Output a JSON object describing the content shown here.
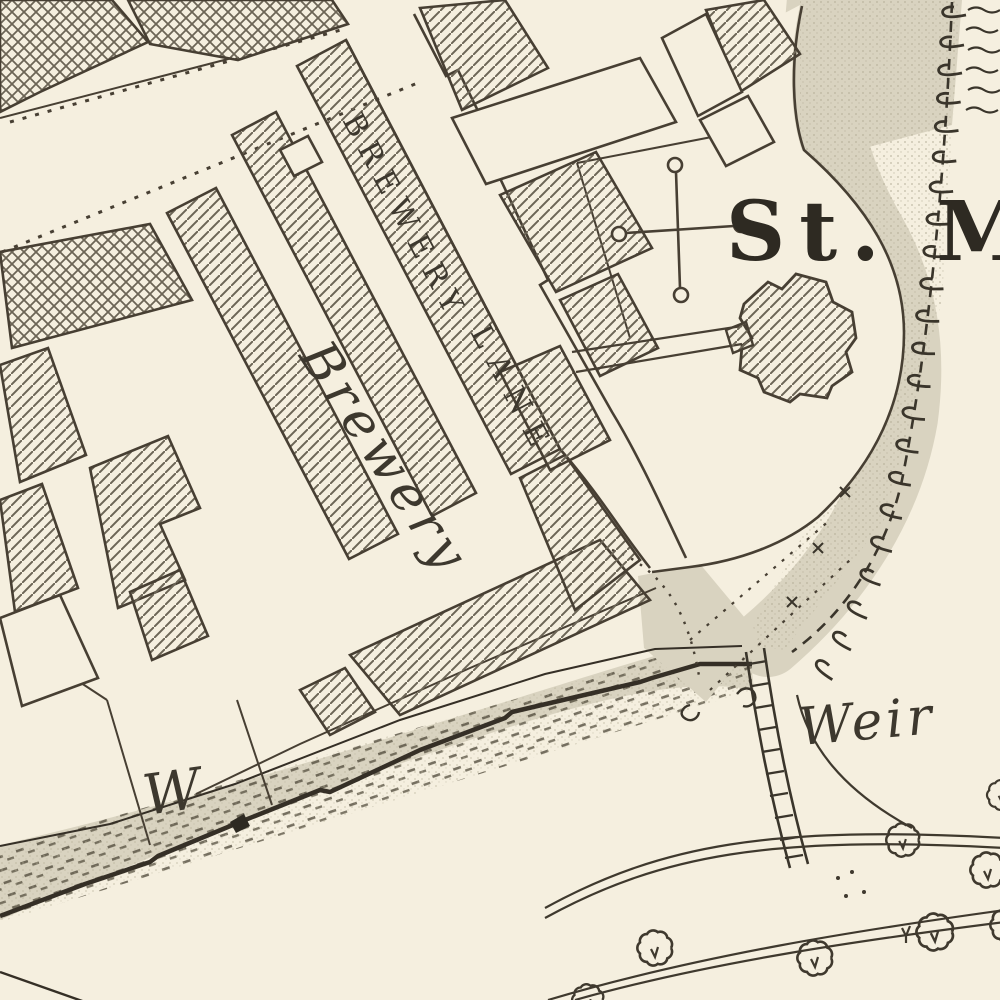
{
  "map": {
    "labels": {
      "street_line1": "BREWERY",
      "street_line2": "LANE",
      "site": "Brewery",
      "church_abbrev": "St. M",
      "weir": "Weir",
      "w_abbrev": "W"
    },
    "colors": {
      "paper": "#f5efdf",
      "ink": "#473f33",
      "shade": "#d9d3c0",
      "hatch": "#6c6556"
    }
  }
}
